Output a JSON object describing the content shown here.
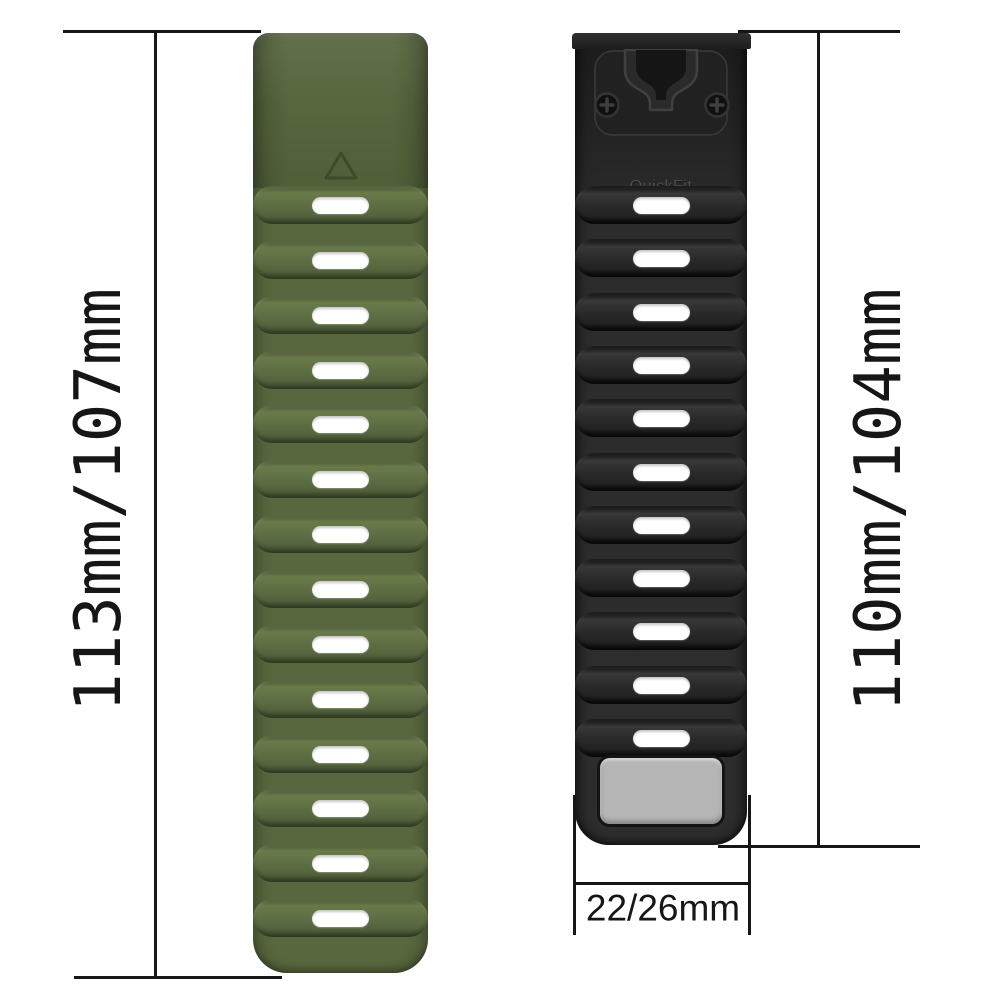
{
  "page_title": "Watch band size diagram",
  "dimensions": {
    "left": {
      "label": "113mm/107mm"
    },
    "right": {
      "label": "110mm/104mm"
    },
    "width": {
      "label": "22/26mm"
    }
  },
  "straps": {
    "green": {
      "name": "army-green silicone band",
      "body_color": "#58673e",
      "slot_count": 14,
      "emblem_icon": "triangle-icon"
    },
    "black": {
      "name": "black silicone band with QuickFit connector",
      "body_color": "#2c2c2c",
      "slot_count": 11,
      "connector_brand": "QuickFit",
      "connector_size": "22",
      "keeper_color": "#b5b5b5",
      "icons": [
        "phillips-screw-icon",
        "quickfit-latch-icon"
      ]
    }
  },
  "style": {
    "line_color": "#161616",
    "slot_color": "#ffffff",
    "background": "#ffffff"
  }
}
